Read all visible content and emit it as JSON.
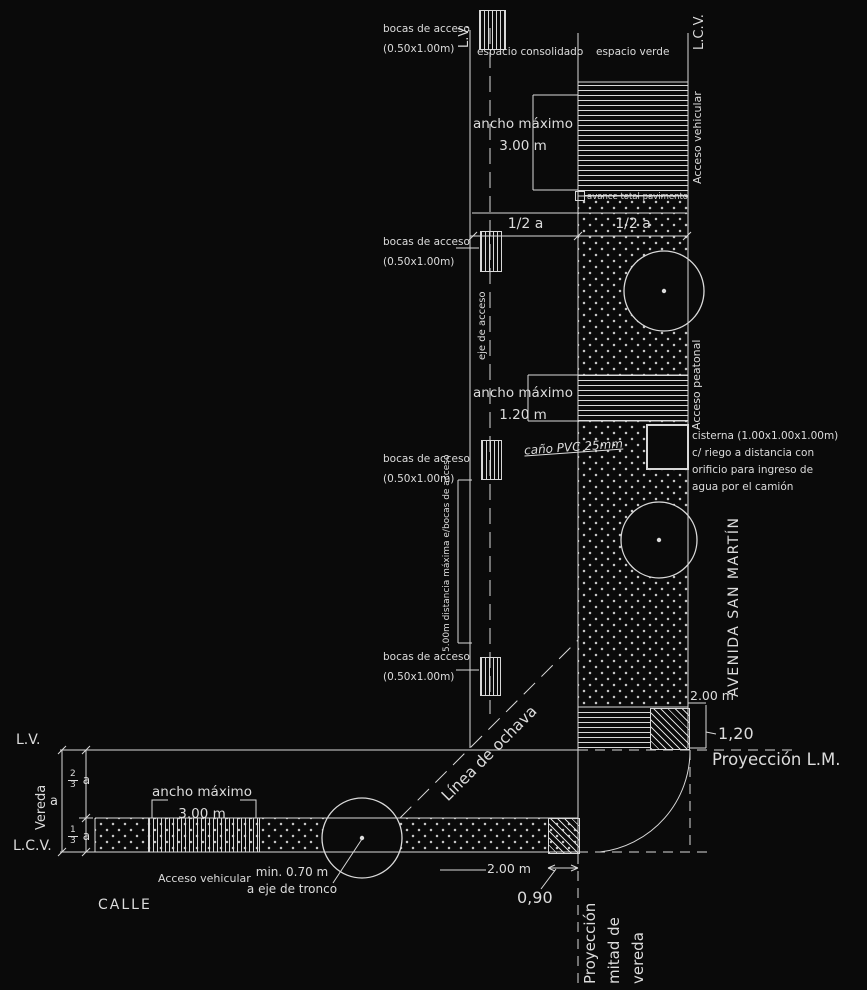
{
  "top": {
    "lv": "L.V.",
    "lcv": "L.C.V.",
    "espacio_consolidado": "espacio consolidado",
    "espacio_verde": "espacio verde",
    "acceso_vehicular": "Acceso vehicular",
    "ancho_maximo_1": "ancho máximo",
    "ancho_maximo_1_val": "3.00 m",
    "avance": "avance total pavimento",
    "half_a_left": "1/2 a",
    "half_a_right": "1/2 a"
  },
  "boca_label": {
    "line1": "bocas de acceso",
    "line2": "(0.50x1.00m)"
  },
  "middle": {
    "eje_de_acceso": "eje de acceso",
    "ancho_maximo_2": "ancho máximo",
    "ancho_maximo_2_val": "1.20 m",
    "cano_pvc": "caño PVC 25mm",
    "acceso_peatonal": "Acceso peatonal",
    "cisterna_l1": "cisterna (1.00x1.00x1.00m)",
    "cisterna_l2": "c/ riego a distancia con",
    "cisterna_l3": "orificio para ingreso de",
    "cisterna_l4": "agua por el camión",
    "dist_maxima": "5.00m distancia máxima e/bocas de acceso",
    "avenida": "AVENIDA SAN MARTÍN",
    "dos_m_top": "2.00 m",
    "uno_20": "1,20",
    "linea_ochava": "Línea de ochava"
  },
  "bottom": {
    "lv": "L.V.",
    "lcv": "L.C.V.",
    "vereda": "Vereda",
    "a": "a",
    "frac23_num": "2",
    "frac23_den": "3",
    "frac23_suffix": "a",
    "frac13_num": "1",
    "frac13_den": "3",
    "frac13_suffix": "a",
    "ancho_maximo": "ancho máximo",
    "ancho_maximo_val": "3.00 m",
    "acceso_vehicular": "Acceso vehicular",
    "min_tronco_l1": "min. 0.70 m",
    "min_tronco_l2": "a eje de tronco",
    "calle": "CALLE",
    "cero_90": "0,90",
    "dos_m": "2.00 m",
    "proyeccion_lm": "Proyección L.M.",
    "proy_mitad_l1": "Proyección",
    "proy_mitad_l2": "mitad de",
    "proy_mitad_l3": "vereda"
  }
}
